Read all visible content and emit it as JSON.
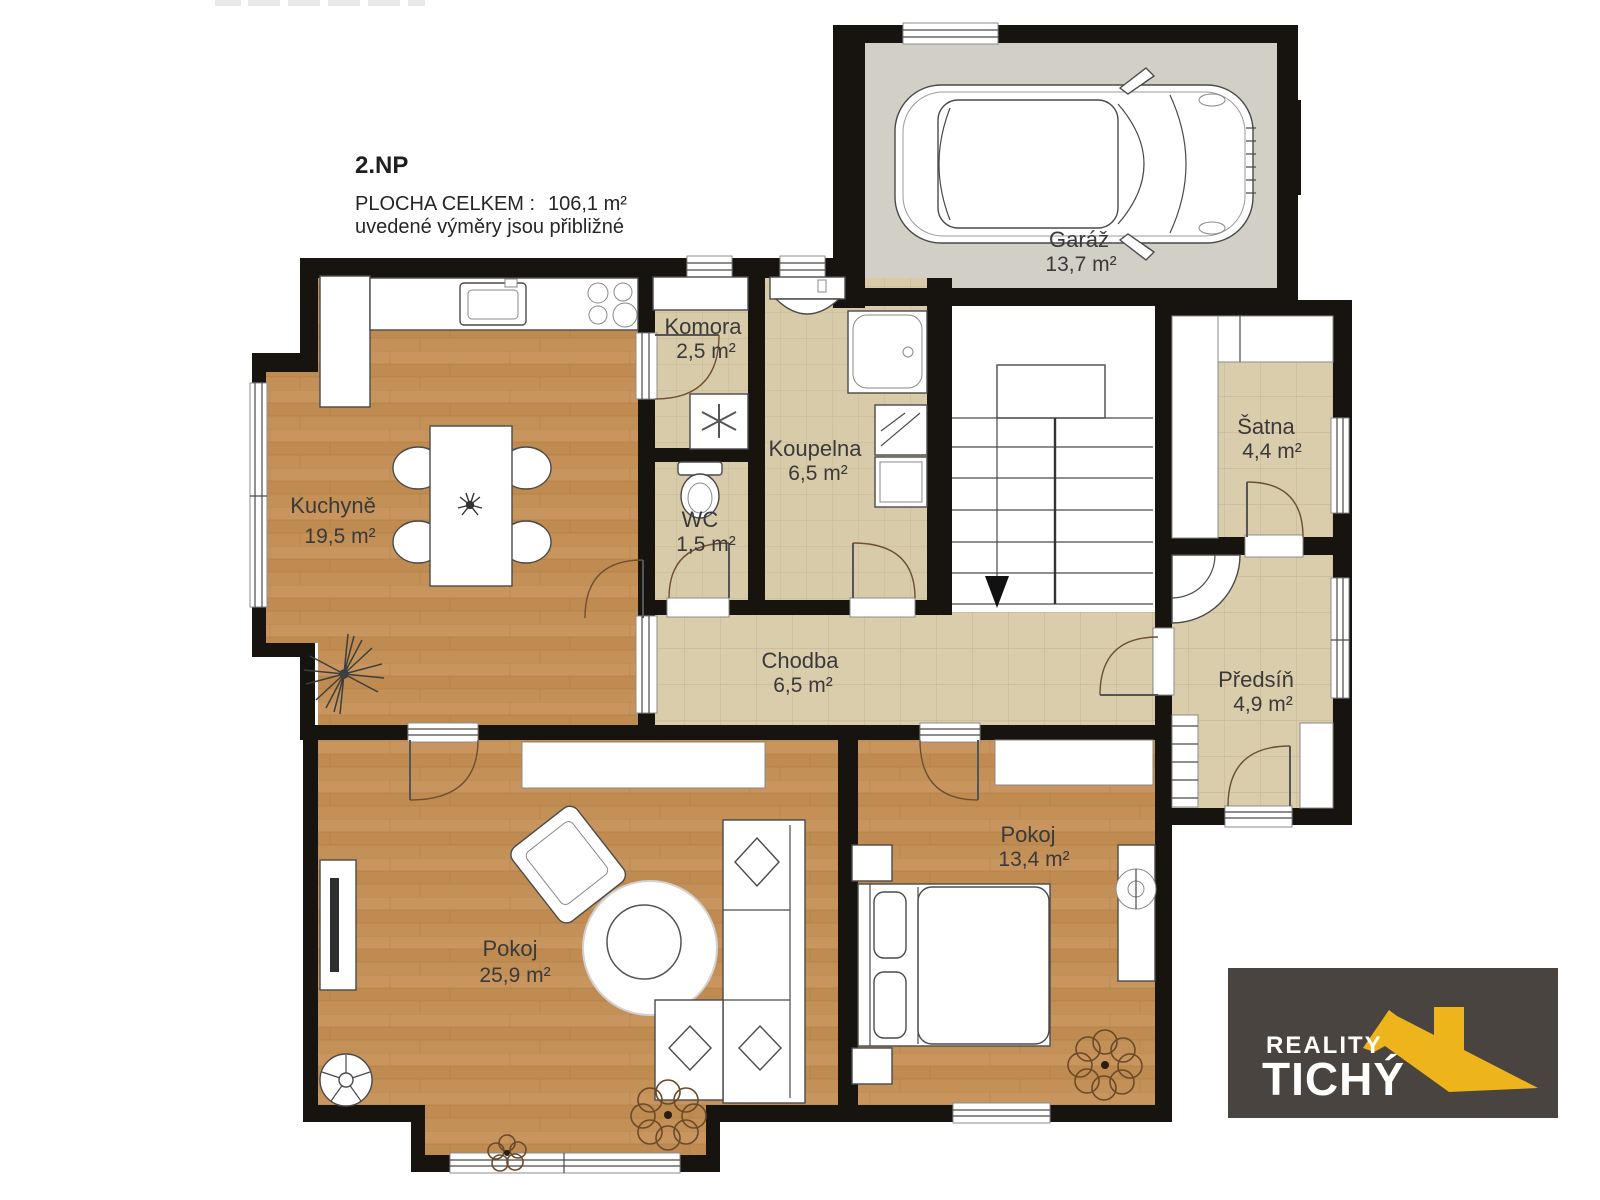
{
  "header": {
    "floor": "2.NP",
    "total_label": "PLOCHA CELKEM :",
    "total_value": "106,1 m²",
    "note": "uvedené výměry jsou přibližné"
  },
  "rooms": {
    "kuchyne": {
      "name": "Kuchyně",
      "area": "19,5 m²"
    },
    "komora": {
      "name": "Komora",
      "area": "2,5 m²"
    },
    "wc": {
      "name": "WC",
      "area": "1,5 m²"
    },
    "koupelna": {
      "name": "Koupelna",
      "area": "6,5 m²"
    },
    "garaz": {
      "name": "Garáž",
      "area": "13,7 m²"
    },
    "satna": {
      "name": "Šatna",
      "area": "4,4 m²"
    },
    "predsin": {
      "name": "Předsíň",
      "area": "4,9 m²"
    },
    "chodba": {
      "name": "Chodba",
      "area": "6,5 m²"
    },
    "pokoj1": {
      "name": "Pokoj",
      "area": "25,9 m²"
    },
    "pokoj2": {
      "name": "Pokoj",
      "area": "13,4 m²"
    }
  },
  "logo": {
    "line1": "REALITY",
    "line2": "TICHÝ"
  },
  "colors": {
    "wall": "#17130e",
    "wood_floor": "#c2905a",
    "tile_floor": "#d9cdab",
    "concrete_floor": "#d2cfc7",
    "logo_background": "#49443f",
    "logo_accent_yellow": "#edb41c"
  }
}
